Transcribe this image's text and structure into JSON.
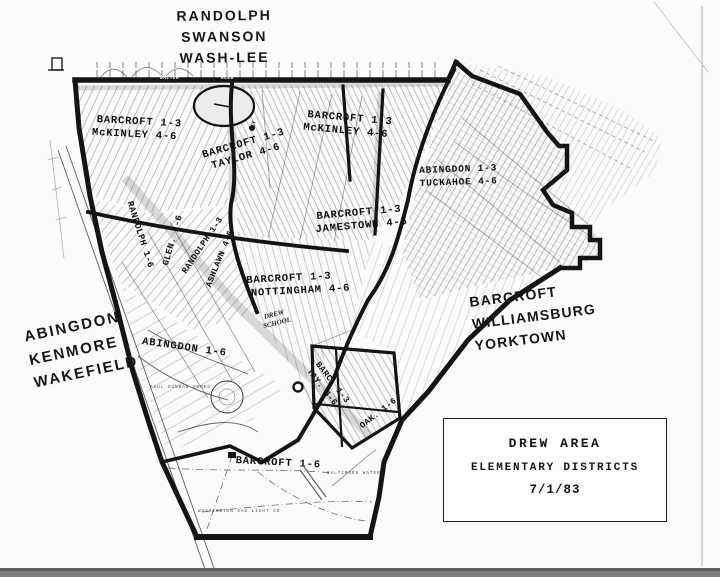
{
  "title": "Drew Area Elementary Districts map",
  "colors": {
    "ink": "#1a1a1a",
    "shade": "#d8d8d8",
    "paper": "#fbfbf9"
  },
  "region_labels": {
    "top": [
      "RANDOLPH",
      "SWANSON",
      "WASH-LEE"
    ],
    "left": [
      "ABINGDON",
      "KENMORE",
      "WAKEFIELD"
    ],
    "right": [
      "BARCROFT",
      "WILLIAMSBURG",
      "YORKTOWN"
    ]
  },
  "district_labels": {
    "mckinley_w": [
      "BARCROFT 1-3",
      "McKINLEY 4-6"
    ],
    "mckinley_e": [
      "BARCROFT 1-3",
      "McKINLEY 4-6"
    ],
    "taylor": [
      "BARCROFT 1-3",
      "TAYLOR 4-6"
    ],
    "tuckahoe": [
      "ABINGDON 1-3",
      "TUCKAHOE 4-6"
    ],
    "jamestown": [
      "BARCROFT 1-3",
      "JAMESTOWN 4-6"
    ],
    "nottingham": [
      "BARCROFT 1-3",
      "NOTTINGHAM 4-6"
    ],
    "randolph_v": "RANDOLPH 1-6",
    "glen_v": "GLEN. 1-6",
    "randolph13_v": "RANDOLPH 1-3",
    "ashlawn_v": "ASHLAWN 4-6",
    "abingdon": "ABINGDON 1-6",
    "barc_tay": [
      "BARC. 1-3",
      "TAY. 4-6"
    ],
    "oak": "OAK. 1-6",
    "barcroft": "BARCROFT 1-6"
  },
  "poi": {
    "school": [
      "DREW",
      "SCHOOL"
    ],
    "walter": "WALTER",
    "reed": "REED",
    "key": "KEY",
    "homes": "PAUL DUNBAR HOMES",
    "gas": "WASHINGTON GAS LIGHT CO",
    "water": "BALTIMORE  WATER"
  },
  "legend": {
    "title": "DREW AREA",
    "subtitle": "ELEMENTARY DISTRICTS",
    "date": "7/1/83"
  }
}
